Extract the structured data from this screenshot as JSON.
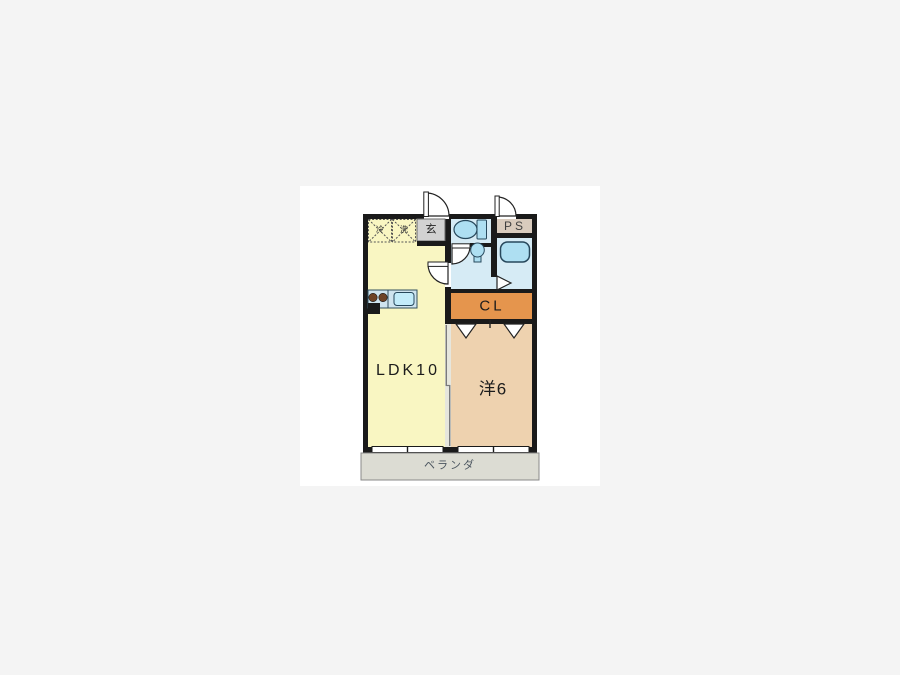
{
  "floorplan": {
    "rooms": {
      "ldk": {
        "label": "LDK10"
      },
      "western": {
        "label": "洋6"
      },
      "closet": {
        "label": "CL"
      },
      "pipe_space": {
        "label": "PS"
      },
      "entrance": {
        "label": "玄"
      },
      "balcony": {
        "label": "ベランダ"
      },
      "fridge_space": {
        "label": "冷"
      },
      "washer_space": {
        "label": "洗"
      }
    },
    "colors": {
      "ldk": "#f9f6c2",
      "western": "#eed2af",
      "closet": "#e5954d",
      "wet_area": "#d6ebf5",
      "fixture": "#aedff2",
      "sink": "#c3ecfa",
      "entrance_floor": "#d2d2d2",
      "pipe_space_bg": "#d9cbbd",
      "balcony_bg": "#dcdcd3",
      "counter": "#cfe4ef",
      "burner": "#6e4326",
      "wall": "#1a1a1a"
    }
  }
}
